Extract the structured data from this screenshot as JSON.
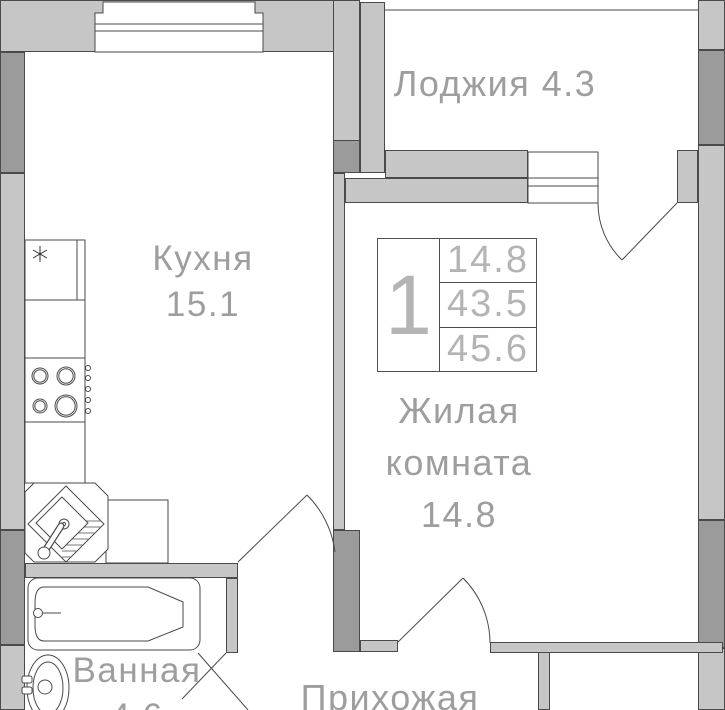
{
  "type": "apartment-floor-plan",
  "rooms": {
    "kitchen": {
      "name": "Кухня",
      "area": "15.1"
    },
    "loggia": {
      "name": "Лоджия",
      "area": "4.3"
    },
    "living_room": {
      "name_line1": "Жилая",
      "name_line2": "комната",
      "area": "14.8"
    },
    "bathroom": {
      "name": "Ванная",
      "area": "4.6"
    },
    "hallway": {
      "name": "Прихожая"
    }
  },
  "stamp": {
    "rooms_count": "1",
    "row1": "14.8",
    "row2": "43.5",
    "row3": "45.6"
  },
  "colors": {
    "wall_light": "#c6c6c6",
    "wall_dark": "#9b9b9b",
    "outline": "#4a4a4a",
    "label_text": "#9e9e9e",
    "stamp_text": "#b4b4b4"
  }
}
